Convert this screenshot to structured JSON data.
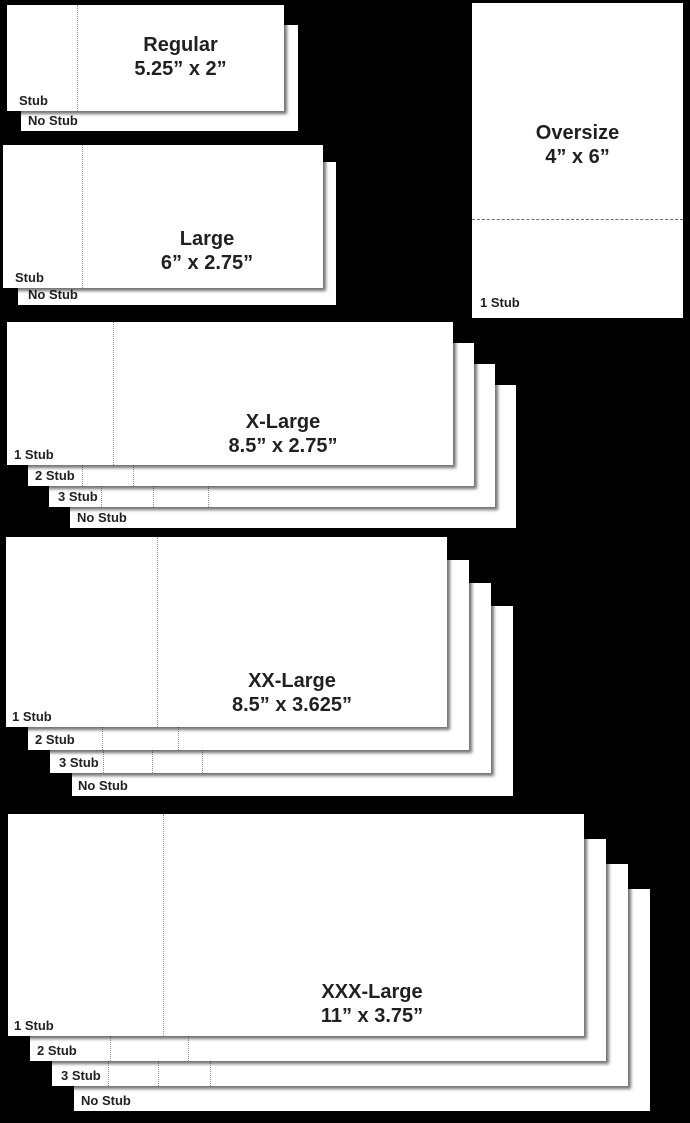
{
  "colors": {
    "background": "#000000",
    "ticket": "#ffffff",
    "text": "#231f20",
    "perforation": "#8f8f8f"
  },
  "sections": [
    {
      "name": "Regular",
      "dimensions": "5.25” x 2”",
      "labels": [
        "Stub",
        "No Stub"
      ]
    },
    {
      "name": "Large",
      "dimensions": "6” x 2.75”",
      "labels": [
        "Stub",
        "No Stub"
      ]
    },
    {
      "name": "Oversize",
      "dimensions": "4” x 6”",
      "labels": [
        "1 Stub"
      ]
    },
    {
      "name": "X-Large",
      "dimensions": "8.5” x 2.75”",
      "labels": [
        "1 Stub",
        "2 Stub",
        "3 Stub",
        "No Stub"
      ]
    },
    {
      "name": "XX-Large",
      "dimensions": "8.5” x 3.625”",
      "labels": [
        "1 Stub",
        "2 Stub",
        "3 Stub",
        "No Stub"
      ]
    },
    {
      "name": "XXX-Large",
      "dimensions": "11” x 3.75”",
      "labels": [
        "1 Stub",
        "2 Stub",
        "3 Stub",
        "No Stub"
      ]
    }
  ]
}
